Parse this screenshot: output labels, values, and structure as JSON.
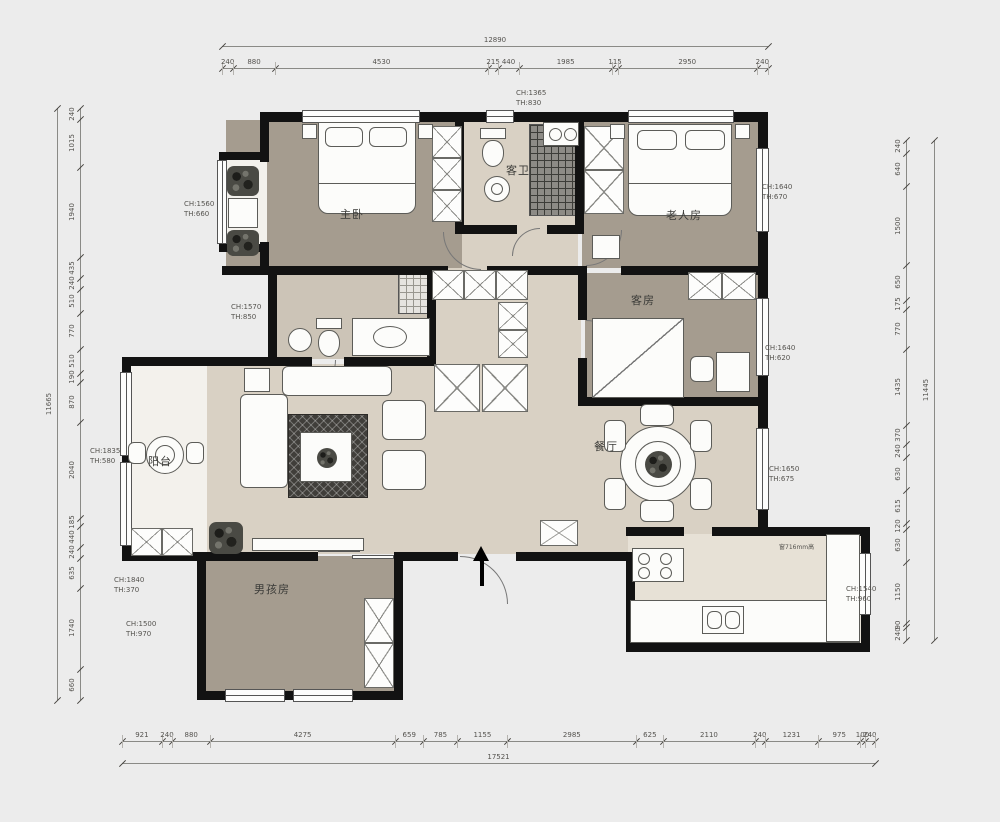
{
  "page": {
    "background": "#ececec",
    "type": "apartment-floor-plan"
  },
  "rooms": [
    {
      "id": "master-bedroom",
      "label": "主卧",
      "x": 352,
      "y": 214
    },
    {
      "id": "guest-bathroom",
      "label": "客卫",
      "x": 518,
      "y": 170
    },
    {
      "id": "elder-bedroom",
      "label": "老人房",
      "x": 684,
      "y": 215
    },
    {
      "id": "guest-bedroom",
      "label": "客房",
      "x": 643,
      "y": 300
    },
    {
      "id": "dining-room",
      "label": "餐厅",
      "x": 606,
      "y": 446
    },
    {
      "id": "balcony",
      "label": "阳台",
      "x": 160,
      "y": 461
    },
    {
      "id": "boys-room",
      "label": "男孩房",
      "x": 272,
      "y": 589
    }
  ],
  "window_notes": [
    {
      "x": 516,
      "y": 88,
      "lines": [
        "CH:1365",
        "TH:830"
      ]
    },
    {
      "x": 184,
      "y": 199,
      "lines": [
        "CH:1560",
        "TH:660"
      ]
    },
    {
      "x": 231,
      "y": 302,
      "lines": [
        "CH:1570",
        "TH:850"
      ]
    },
    {
      "x": 90,
      "y": 446,
      "lines": [
        "CH:1835",
        "TH:580"
      ]
    },
    {
      "x": 114,
      "y": 575,
      "lines": [
        "CH:1840",
        "TH:370"
      ]
    },
    {
      "x": 126,
      "y": 619,
      "lines": [
        "CH:1500",
        "TH:970"
      ]
    },
    {
      "x": 762,
      "y": 182,
      "lines": [
        "CH:1640",
        "TH:670"
      ]
    },
    {
      "x": 765,
      "y": 343,
      "lines": [
        "CH:1640",
        "TH:620"
      ]
    },
    {
      "x": 769,
      "y": 464,
      "lines": [
        "CH:1650",
        "TH:675"
      ]
    },
    {
      "x": 846,
      "y": 584,
      "lines": [
        "CH:1540",
        "TH:960"
      ]
    }
  ],
  "kitchen_note": {
    "x": 779,
    "y": 544,
    "text": "窗716mm高"
  },
  "dimensions": {
    "top": {
      "overall": "12890",
      "segments": [
        "240",
        "880",
        "4530",
        "215",
        "440",
        "1985",
        "115",
        "2950",
        "240"
      ]
    },
    "bottom": {
      "overall": "17521",
      "segments": [
        "921",
        "240",
        "880",
        "4275",
        "659",
        "785",
        "1155",
        "2985",
        "625",
        "2110",
        "240",
        "1231",
        "975",
        "100",
        "240"
      ]
    },
    "left": {
      "overall": "11665",
      "segments": [
        "240",
        "1015",
        "1940",
        "435",
        "240",
        "510",
        "770",
        "510",
        "190",
        "870",
        "2040",
        "185",
        "440",
        "240",
        "635",
        "1740",
        "660"
      ]
    },
    "right": {
      "overall": "11445",
      "segments": [
        "240",
        "640",
        "1500",
        "650",
        "175",
        "770",
        "1435",
        "370",
        "240",
        "630",
        "615",
        "120",
        "630",
        "1150",
        "90",
        "240"
      ]
    }
  },
  "colors": {
    "wall": "#121212",
    "floor_bedroom": "#a59c8f",
    "floor_main": "#d9d1c4",
    "floor_light": "#f3f1ec",
    "floor_bath": "#ccc4b7",
    "floor_kitchen": "#e7e1d6",
    "dim_text": "#55534f"
  }
}
